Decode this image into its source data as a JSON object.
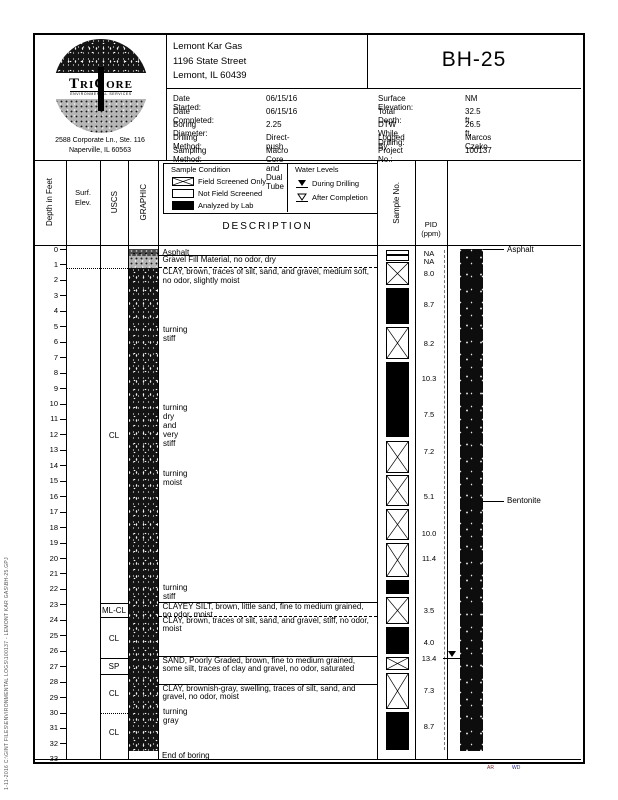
{
  "header": {
    "client": [
      "Lemont Kar Gas",
      "1196 State Street",
      "Lemont, IL 60439"
    ],
    "boring_id": "BH-25",
    "details_left": [
      {
        "label": "Date Started:",
        "value": "06/15/16"
      },
      {
        "label": "Date Completed:",
        "value": "06/15/16"
      },
      {
        "label": "Boring Diameter:",
        "value": "2.25"
      },
      {
        "label": "Drilling Method:",
        "value": "Direct-push"
      },
      {
        "label": "Sampling Method:",
        "value": "Macro Core and Dual Tube"
      }
    ],
    "details_right": [
      {
        "label": "Surface Elevation:",
        "value": "NM"
      },
      {
        "label": "Total Depth:",
        "value": "32.5 ft."
      },
      {
        "label": "DTW While Drilling:",
        "value": "26.5 ft."
      },
      {
        "label": "Logged By:",
        "value": "Marcos Czako"
      },
      {
        "label": "Project No.:",
        "value": "100137"
      }
    ],
    "logo": {
      "brand": "TriCore",
      "tagline": "ENVIRONMENTAL SERVICES",
      "address": [
        "2588 Corporate Ln., Ste. 116",
        "Naperville, IL 60563"
      ]
    }
  },
  "columns": {
    "depth": "Depth in Feet",
    "surf_elev": [
      "Surf.",
      "Elev."
    ],
    "uscs": "USCS",
    "graphic": "GRAPHIC",
    "description": "DESCRIPTION",
    "sample_no": "Sample No.",
    "pid": [
      "PID",
      "(ppm)"
    ]
  },
  "legend": {
    "sample_condition": {
      "title": "Sample Condition",
      "items": [
        {
          "icon": "field-screened-icon",
          "label": "Field Screened Only"
        },
        {
          "icon": "not-field-screened-icon",
          "label": "Not Field Screened"
        },
        {
          "icon": "analyzed-by-lab-icon",
          "label": "Analyzed by Lab"
        }
      ]
    },
    "water_levels": {
      "title": "Water Levels",
      "items": [
        {
          "icon": "water-during-drilling-icon",
          "label": "During Drilling"
        },
        {
          "icon": "water-after-completion-icon",
          "label": "After Completion"
        }
      ]
    }
  },
  "log": {
    "axis": {
      "unit": "ft",
      "min": 0,
      "max": 33,
      "tick_every": 1
    },
    "uscs_layers": [
      {
        "label": "CL",
        "top": 1.25,
        "bottom": 22.9,
        "top_style": "dotted"
      },
      {
        "label": "ML-CL",
        "top": 22.9,
        "bottom": 23.8,
        "top_style": "solid"
      },
      {
        "label": "CL",
        "top": 23.8,
        "bottom": 26.5,
        "top_style": "solid"
      },
      {
        "label": "SP",
        "top": 26.5,
        "bottom": 27.5,
        "top_style": "solid"
      },
      {
        "label": "CL",
        "top": 27.5,
        "bottom": 30.0,
        "top_style": "solid"
      },
      {
        "label": "CL",
        "top": 30.0,
        "bottom": 32.5,
        "top_style": "dotted"
      }
    ],
    "graphic_bands": [
      {
        "pattern": "asphalt",
        "top": 0,
        "bottom": 0.45
      },
      {
        "pattern": "gravel",
        "top": 0.45,
        "bottom": 1.25
      },
      {
        "pattern": "clay-dark",
        "top": 1.25,
        "bottom": 32.5
      }
    ],
    "strata": [
      {
        "top": 0,
        "bottom": 0.45,
        "text": "Asphalt",
        "boundary": "solid"
      },
      {
        "top": 0.45,
        "bottom": 1.25,
        "text": "Gravel Fill Material, no odor, dry",
        "boundary": "dashed"
      },
      {
        "top": 1.25,
        "bottom": 22.9,
        "text": "CLAY, brown, traces of silt, sand, and gravel, medium soft, no odor, slightly moist",
        "boundary": "solid"
      },
      {
        "top": 22.9,
        "bottom": 23.8,
        "text": "CLAYEY SILT, brown, little sand, fine to medium grained, no odor, moist",
        "boundary": "dashed"
      },
      {
        "top": 23.8,
        "bottom": 26.4,
        "text": "CLAY, brown, traces of silt, sand, and gravel, stiff, no odor, moist",
        "boundary": "solid"
      },
      {
        "top": 26.4,
        "bottom": 28.2,
        "text": "SAND, Poorly Graded, brown, fine to medium grained, some silt, traces of clay and gravel, no odor, saturated",
        "boundary": "solid"
      },
      {
        "top": 28.2,
        "bottom": 32.5,
        "text": "CLAY, brownish-gray, swelling, traces of silt, sand, and gravel, no odor, moist",
        "boundary": "none"
      }
    ],
    "notes": [
      {
        "depth": 5.2,
        "text": "turning stiff"
      },
      {
        "depth": 10.2,
        "text": "turning dry and very stiff"
      },
      {
        "depth": 14.5,
        "text": "turning moist"
      },
      {
        "depth": 21.9,
        "text": "turning stiff"
      },
      {
        "depth": 29.9,
        "text": "turning gray"
      }
    ],
    "samples": [
      {
        "top": 0.05,
        "bottom": 0.4,
        "type": "empty"
      },
      {
        "top": 0.4,
        "bottom": 0.75,
        "type": "empty"
      },
      {
        "top": 0.85,
        "bottom": 2.35,
        "type": "field"
      },
      {
        "top": 2.55,
        "bottom": 4.85,
        "type": "lab"
      },
      {
        "top": 5.05,
        "bottom": 7.1,
        "type": "field"
      },
      {
        "top": 7.3,
        "bottom": 12.2,
        "type": "lab"
      },
      {
        "top": 12.4,
        "bottom": 14.5,
        "type": "field"
      },
      {
        "top": 14.65,
        "bottom": 16.65,
        "type": "field"
      },
      {
        "top": 16.85,
        "bottom": 18.85,
        "type": "field"
      },
      {
        "top": 19.05,
        "bottom": 21.25,
        "type": "field"
      },
      {
        "top": 21.45,
        "bottom": 22.35,
        "type": "lab"
      },
      {
        "top": 22.55,
        "bottom": 24.25,
        "type": "field"
      },
      {
        "top": 24.45,
        "bottom": 26.2,
        "type": "lab"
      },
      {
        "top": 26.4,
        "bottom": 27.25,
        "type": "field"
      },
      {
        "top": 27.45,
        "bottom": 29.75,
        "type": "field"
      },
      {
        "top": 29.95,
        "bottom": 32.4,
        "type": "lab"
      }
    ],
    "pid_values": [
      {
        "depth": 0.3,
        "value": "NA"
      },
      {
        "depth": 0.8,
        "value": "NA"
      },
      {
        "depth": 1.6,
        "value": "8.0"
      },
      {
        "depth": 3.6,
        "value": "8.7"
      },
      {
        "depth": 6.1,
        "value": "8.2"
      },
      {
        "depth": 8.4,
        "value": "10.3"
      },
      {
        "depth": 10.7,
        "value": "7.5"
      },
      {
        "depth": 13.1,
        "value": "7.2"
      },
      {
        "depth": 16.0,
        "value": "5.1"
      },
      {
        "depth": 18.4,
        "value": "10.0"
      },
      {
        "depth": 20.0,
        "value": "11.4"
      },
      {
        "depth": 23.4,
        "value": "3.5"
      },
      {
        "depth": 25.5,
        "value": "4.0"
      },
      {
        "depth": 26.5,
        "value": "13.4"
      },
      {
        "depth": 28.6,
        "value": "7.3"
      },
      {
        "depth": 30.9,
        "value": "8.7"
      }
    ],
    "well": {
      "bottom": 32.5,
      "labels": [
        {
          "depth": 0.0,
          "text": "Asphalt"
        },
        {
          "depth": 16.3,
          "text": "Bentonite"
        }
      ]
    },
    "water_level": {
      "depth": 26.5
    },
    "end_text": "End of boring"
  },
  "footer": {
    "marks": [
      "AR",
      "WD"
    ]
  },
  "sidebar_path": "1-11-2016  C:\\GINT FILES\\ENVIRONMENTAL LOGS\\100137 - LEMONT KAR GAS\\BH-25.GPJ"
}
